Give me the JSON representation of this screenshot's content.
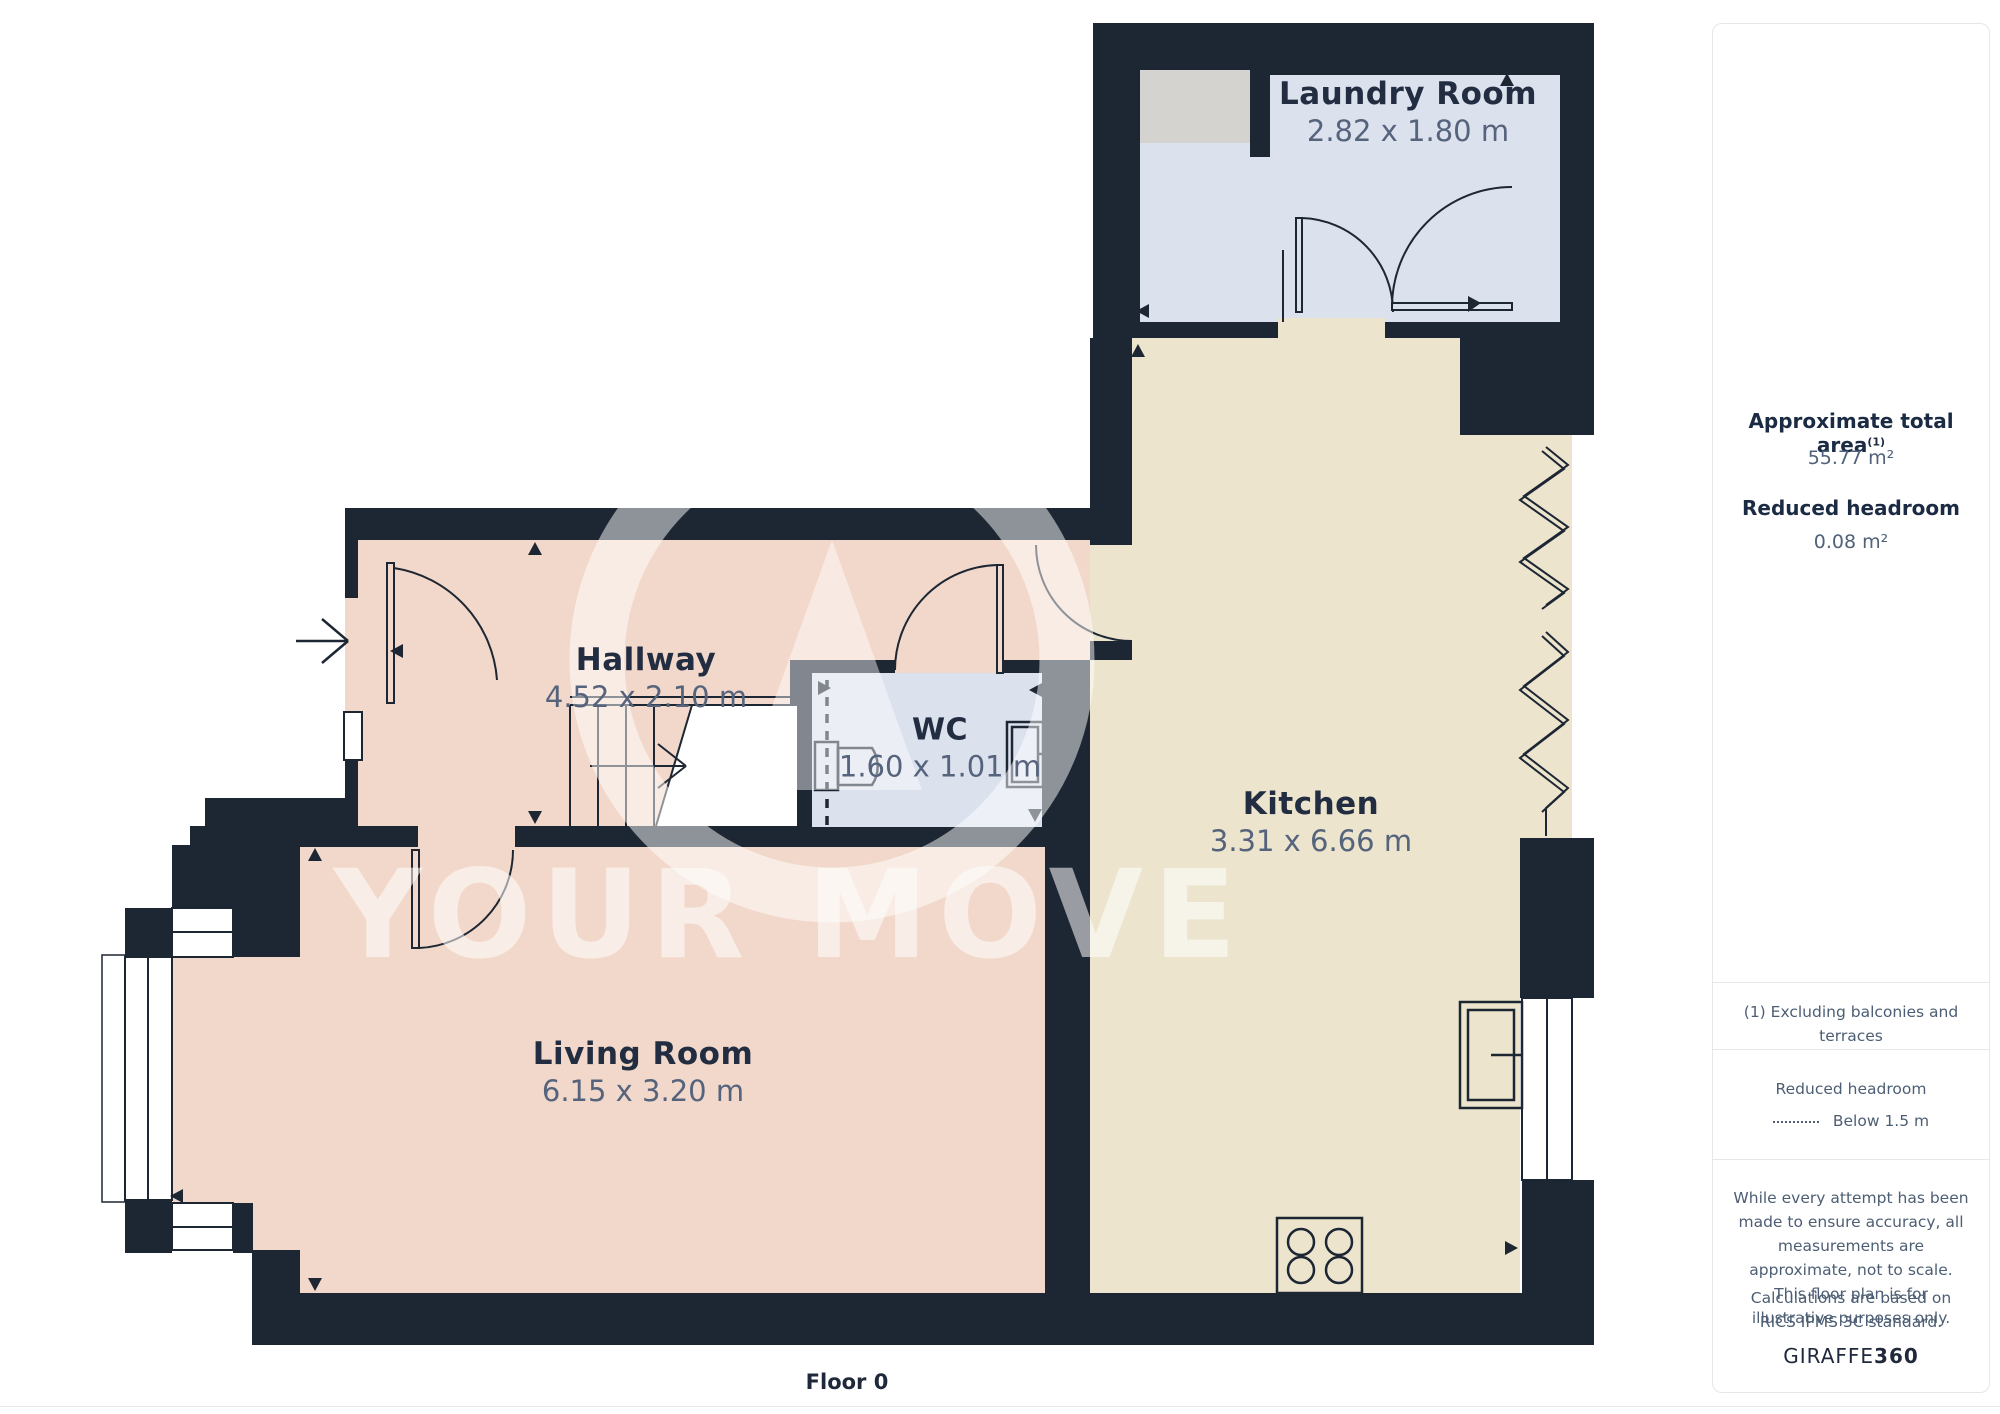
{
  "floorplan": {
    "floor_label": "Floor 0",
    "watermark": "YOUR MOVE",
    "rooms": {
      "laundry": {
        "name": "Laundry Room",
        "dims": "2.82 x 1.80 m"
      },
      "hallway": {
        "name": "Hallway",
        "dims": "4.52 x 2.10 m"
      },
      "wc": {
        "name": "WC",
        "dims": "1.60 x 1.01 m"
      },
      "kitchen": {
        "name": "Kitchen",
        "dims": "3.31 x 6.66 m"
      },
      "living": {
        "name": "Living Room",
        "dims": "6.15 x 3.20 m"
      }
    },
    "colors": {
      "wall": "#1d2633",
      "room_pink": "#f2d8ca",
      "room_cream": "#ece4cd",
      "room_blue": "#dce1ee",
      "appliance_gray": "#d5d3cf"
    }
  },
  "sidebar": {
    "total_area_label": "Approximate total area",
    "total_area_superscript": "(1)",
    "total_area_value": "55.77 m²",
    "reduced_headroom_label": "Reduced headroom",
    "reduced_headroom_value": "0.08 m²",
    "footnote": "(1) Excluding balconies and terraces",
    "legend_title": "Reduced headroom",
    "legend_item": "Below 1.5 m",
    "disclaimer1": "While every attempt has been made to ensure accuracy, all measurements are approximate, not to scale. This floor plan is for illustrative purposes only.",
    "disclaimer2": "Calculations are based on RICS IPMS 3C standard.",
    "brand_regular": "GIRAFFE",
    "brand_bold": "360"
  }
}
